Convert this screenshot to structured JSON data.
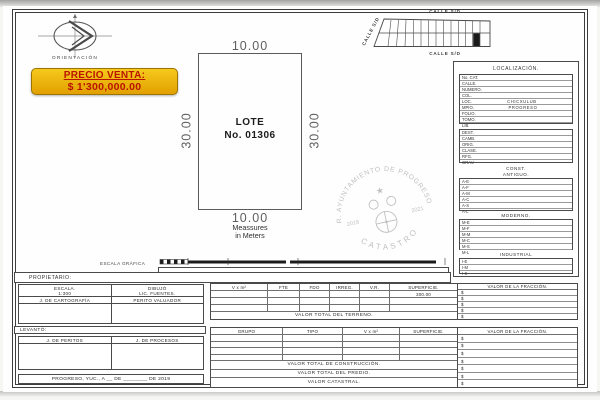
{
  "doc": {
    "orientation_label": "ORIENTACIÓN",
    "banner": {
      "title": "PRECIO VENTA:",
      "price": "$ 1'300,000.00"
    },
    "lot": {
      "line1": "LOTE",
      "line2": "No. 01306",
      "dim_top": "10.00",
      "dim_bottom": "10.00",
      "dim_left": "30.00",
      "dim_right": "30.00",
      "units1": "Meassures",
      "units2": "in Meters"
    },
    "block_map": {
      "street_top": "CALLE S/D",
      "street_bottom": "CALLE S/D",
      "street_left": "CALLE S/D"
    },
    "seal": {
      "arc_top": "R. AYUNTAMIENTO DE PROGRESO",
      "arc_bottom": "CATASTRO",
      "year_left": "2018",
      "year_right": "2021",
      "star": "★"
    },
    "scale_label": "ESCALA GRÁFICA",
    "owner_label": "PROPIETARIO:",
    "date_line": "PROGRESO, YUC., A __ DE ________ DE 2019"
  },
  "localization": {
    "title": "LOCALIZACIÓN.",
    "rows": [
      {
        "label": "No. CAT.",
        "value": ""
      },
      {
        "label": "CALLE.",
        "value": ""
      },
      {
        "label": "NUMERO.",
        "value": ""
      },
      {
        "label": "COL.",
        "value": ""
      },
      {
        "label": "LOC.",
        "value": "CHICXULUB"
      },
      {
        "label": "MPIO.",
        "value": "PROGRESO"
      },
      {
        "label": "FOLIO.",
        "value": ""
      },
      {
        "label": "TOMO.",
        "value": ""
      },
      {
        "label": "LIB.",
        "value": ""
      }
    ],
    "admin_rows": [
      "DEST.",
      "CAMB.",
      "ORIG.",
      "CLASE.",
      "RFG.",
      "GRAV."
    ],
    "const_title": "CONST.",
    "antiguo_title": "ANTIGUO.",
    "antiguo_rows": [
      "A-E",
      "A-F",
      "A-M",
      "A-C",
      "A-S",
      "A-L"
    ],
    "moderno_title": "MODERNO.",
    "moderno_rows": [
      "M-E",
      "M-F",
      "M-M",
      "M-C",
      "M-S",
      "M-L"
    ],
    "industrial_title": "INDUSTRIAL",
    "industrial_rows": [
      "I-E",
      "I-M",
      "I-S"
    ]
  },
  "credits": {
    "escala_label": "ESCALA.",
    "escala_value": "1:300",
    "dibujo_label": "DIBUJÓ",
    "dibujo_value": "LIC. FUENTES.",
    "cartografia": "J. DE CARTOGRAFÍA",
    "perito": "PERITO VALUADOR",
    "levanto_label": "LEVANTÓ:",
    "peritos": "J. DE PERITOS",
    "procesos": "J. DE PROCESOS"
  },
  "terrain_table": {
    "headers": [
      "V x m²",
      "FTE",
      "FDO",
      "IRREG.",
      "V.R.",
      "SUPERFICIE."
    ],
    "fraction_header": "VALOR DE LA FRACCIÓN.",
    "superficie_value": "300.00",
    "currency": "$",
    "total_label": "VALOR TOTAL DEL TERRENO."
  },
  "construction_table": {
    "headers": [
      "GRUPO",
      "TIPO",
      "V x m²",
      "SUPERFICIE."
    ],
    "fraction_header": "VALOR DE LA FRACCIÓN.",
    "currency": "$",
    "total_rows": [
      "VALOR TOTAL DE CONSTRUCCIÓN.",
      "VALOR TOTAL DEL PREDIO.",
      "VALOR CATASTRAL."
    ]
  },
  "colors": {
    "banner_bg": "#eeb000",
    "banner_text": "#b81400",
    "line": "#4a4a4a",
    "seal": "#8e8e8e",
    "highlight_cell": "#1a1a1a"
  }
}
